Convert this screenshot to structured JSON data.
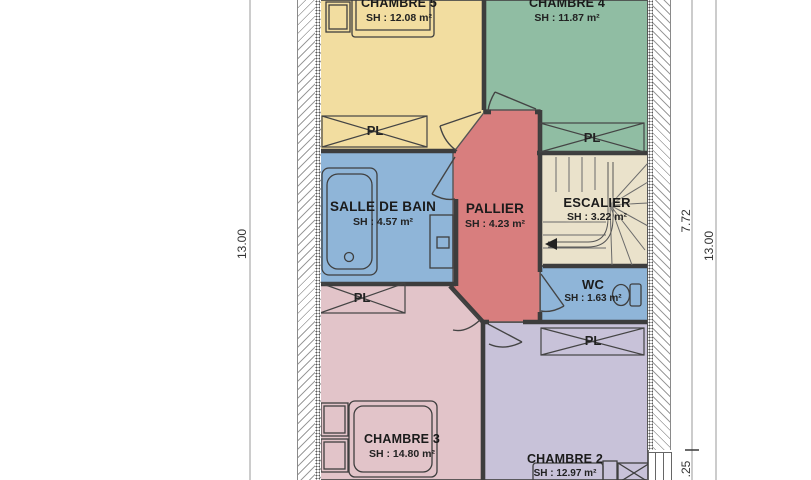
{
  "plan": {
    "title": "floor-plan-upper-level",
    "rooms": {
      "chambre5": {
        "name": "CHAMBRE 5",
        "area": "SH : 12.08 m²",
        "color": "#f2dda0"
      },
      "chambre4": {
        "name": "CHAMBRE 4",
        "area": "SH : 11.87 m²",
        "color": "#90bda3"
      },
      "salle_de_bain": {
        "name": "SALLE DE BAIN",
        "area": "SH : 4.57 m²",
        "color": "#8fb5d8"
      },
      "pallier": {
        "name": "PALLIER",
        "area": "SH : 4.23 m²",
        "color": "#d87e7e"
      },
      "escalier": {
        "name": "ESCALIER",
        "area": "SH : 3.22 m²",
        "color": "#eae2cb"
      },
      "wc": {
        "name": "WC",
        "area": "SH : 1.63 m²",
        "color": "#8fb5d8"
      },
      "chambre3": {
        "name": "CHAMBRE 3",
        "area": "SH : 14.80 m²",
        "color": "#e2c4c9"
      },
      "chambre2": {
        "name": "CHAMBRE 2",
        "area": "SH : 12.97 m²",
        "color": "#c8c2d9"
      }
    },
    "closet_label": "PL",
    "dimensions": {
      "left": "13.00",
      "right_inner": "7.72",
      "right_outer": "13.00",
      "bottom_right": ".25"
    }
  }
}
